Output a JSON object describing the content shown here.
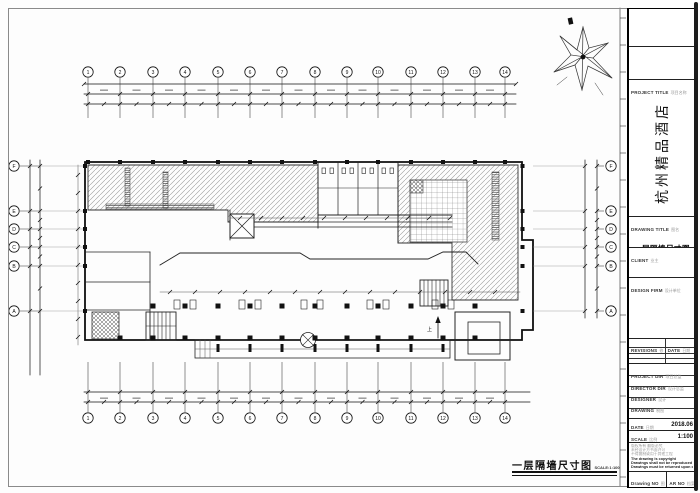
{
  "sheet": {
    "drawing_label": "一层隔墙尺寸图",
    "scale_note": "SCALE:1:100"
  },
  "colors": {
    "line": "#111111",
    "hatch": "#8a8a8a",
    "paper": "#fdfdfd"
  },
  "grid": {
    "columns": [
      "1",
      "2",
      "3",
      "4",
      "5",
      "6",
      "7",
      "8",
      "9",
      "10",
      "11",
      "12",
      "13",
      "14"
    ],
    "rows": [
      "F",
      "E",
      "D",
      "C",
      "B",
      "A"
    ]
  },
  "plan": {
    "up_label": "上"
  },
  "title_block": {
    "project_title_label": "PROJECT TITLE",
    "project_title_label_cn": "项目名称",
    "project_title": "杭州精品酒店",
    "drawing_title_label": "DRAWING TITLE",
    "drawing_title_label_cn": "图名",
    "drawing_title": "一层隔墙尺寸图",
    "client_label": "CLIENT",
    "client_label_cn": "业主",
    "design_firm_label": "DESIGN FIRM",
    "design_firm_label_cn": "设计单位",
    "revisions_label": "REVISIONS",
    "revisions_label_cn": "修改",
    "revision_date_label": "DATE",
    "revision_date_label_cn": "日期",
    "fields": [
      {
        "label": "PROJECT DIR",
        "label_cn": "项目总监"
      },
      {
        "label": "DIRECTOR DIR",
        "label_cn": "设计总监"
      },
      {
        "label": "DESIGNER",
        "label_cn": "设计"
      },
      {
        "label": "DRAWING",
        "label_cn": "制图"
      },
      {
        "label": "CHECKED BY",
        "label_cn": "审核"
      }
    ],
    "date_label": "DATE",
    "date_label_cn": "日期",
    "date_value": "2018.06",
    "scale_label": "SCALE",
    "scale_label_cn": "比例",
    "scale_value": "1:100",
    "notes": [
      "版权所有 翻版必究",
      "未经设计方书面许可",
      "不得复制或用于其他工程",
      "The drawing is copyright",
      "Drawings shall not be reproduced or altered",
      "Drawings must be returned upon completion"
    ],
    "drawing_no_label": "Drawing NO",
    "drawing_no_label_cn": "图号",
    "drawing_no_value": "LF-2F-02",
    "ar_no_label": "AR NO",
    "ar_no_label_cn": "档案号"
  }
}
